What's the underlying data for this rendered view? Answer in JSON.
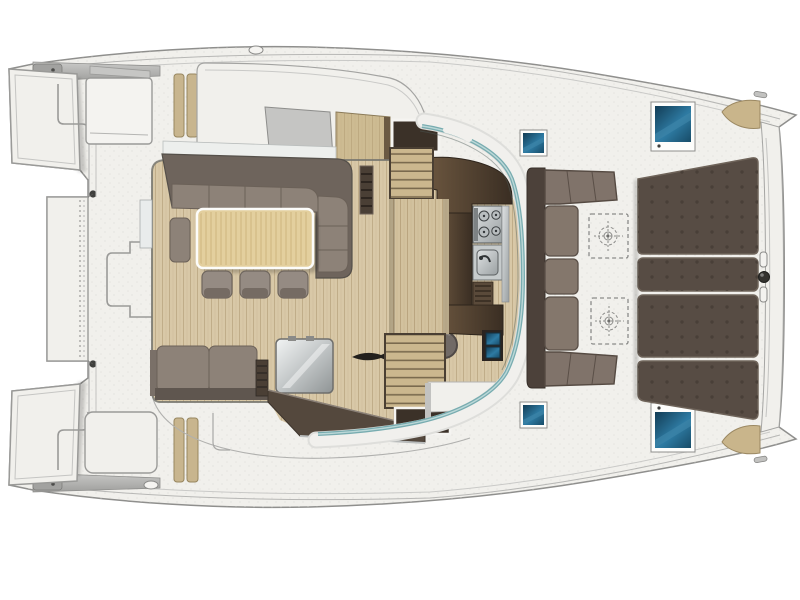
{
  "meta": {
    "kind": "catamaran-deck-layout-plan",
    "view": "top-down cutaway",
    "bow_direction": "right",
    "stern_direction": "left",
    "visible_text": "none"
  },
  "colors": {
    "background": "#ffffff",
    "deck": "#f1f0ec",
    "deck_edge": "#8f8f8d",
    "deck_line": "#b7b7b5",
    "gunwale_gray": "#b3b3b1",
    "gunwale_dark": "#9a9a98",
    "wood_floor": "#d8c8a7",
    "wood_walkway": "#d2c19e",
    "wood_step": "#cbb78e",
    "wood_table": "#e3cf9e",
    "tan_step_pad": "#c8b58e",
    "cabinet_wood": "#cdbb92",
    "skylight_gray": "#c5c5c3",
    "sofa_back": "#6e645c",
    "sofa_seat": "#8d8278",
    "bench_seat": "#8d8278",
    "stool": "#958b83",
    "stool_band": "#756b63",
    "counter_dark": "#47382b",
    "counter_light": "#6b563f",
    "louver_dark": "#4a3f35",
    "steel_light": "#dfe2e3",
    "steel_mid": "#b9bec0",
    "glass_teal": "#78acb0",
    "glass_teal_light": "#bcd8d8",
    "wall_band": "#f1f0ed",
    "hatch_frame": "#fdfdfb",
    "hatch_blue": "#1d5577",
    "hatch_blue_hi": "#3d85a8",
    "sunpad": "#574c44",
    "sunpad_dot": "#463d36",
    "sunpad_edge": "#6f645a",
    "cockpit_backrest": "#4c413a",
    "cockpit_corner": "#80736a",
    "beige_pad": "#c9b58b",
    "fitting_dark": "#33322f",
    "stair_opening": "#3b3128",
    "sideboard": "#54483d",
    "metal_box_hi": "#f2f4f4",
    "metal_box_lo": "#8f9495"
  },
  "inventory": {
    "stern": {
      "transom_step_panels": 2,
      "aft_platform": 1,
      "mooring_posts": 2,
      "deck_step_outline": 1
    },
    "side_decks": {
      "tan_step_pads_per_side": 2,
      "oval_cleats": 2,
      "cabin_top_panels": 2
    },
    "saloon": {
      "sofa_shape": "L",
      "sofa_seat_cushions": 4,
      "armrest_pads": 1,
      "dining_table": 1,
      "stools": 3,
      "aft_bench_cushions": 2,
      "louver_vents": 2,
      "cooler_box_stainless": 1,
      "decor_fish_motif": 1,
      "round_stool": 1,
      "skylight": 1,
      "companionway_cabinet": 1
    },
    "galley": {
      "stove_burners": 4,
      "sinks": 1,
      "louver_locker": 1,
      "blue_front_drawers": 2
    },
    "companionways": {
      "port_stairs": 1,
      "starboard_stairs": 1,
      "central_wood_walkway": 1
    },
    "glass_wall": {
      "shape": "wrap-around curve",
      "door_gap": 1
    },
    "forward_cockpit": {
      "bench_shape": "C",
      "straight_cushions": 3,
      "corner_seats": 2,
      "dashed_deck_lockers": 2
    },
    "deck_hatches": {
      "large_blue": 2,
      "small_blue": 2
    },
    "foredeck": {
      "sunpad_panels": 4,
      "surface_texture": "button dots"
    },
    "bow": {
      "crossbeam": 1,
      "bridle_knob": 1,
      "bridle_pins": 2,
      "beige_bow_pads": 2,
      "sheer_cleats": 2
    }
  }
}
